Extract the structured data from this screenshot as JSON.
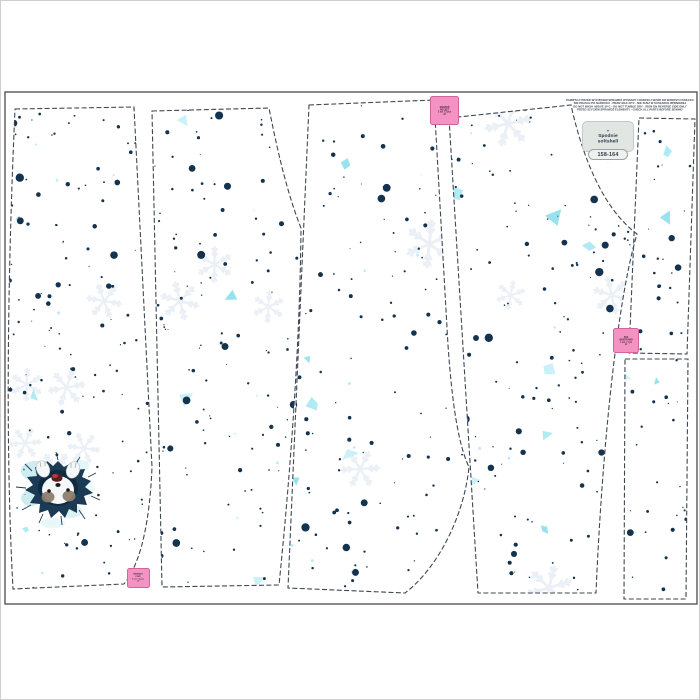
{
  "meta": {
    "title": "Fabric sewing-pattern panel preview — softshell pants, husky print"
  },
  "colors": {
    "background": "#ffffff",
    "panel_border": "#4a4a4a",
    "piece_outline": "#3f4753",
    "dot": "#14334f",
    "shards": [
      "#a9e8f1",
      "#c6f0f6",
      "#8fe0ec"
    ],
    "snowflake": "#e6edf4",
    "pink_label_bg": "#f492c2",
    "pink_label_border": "#d2639c",
    "size_tag_bg": "#e1e6e3"
  },
  "print": {
    "seed": 12,
    "dot_count": 560,
    "speck_count": 28,
    "shard_count": 24,
    "snowflake_count": 15
  },
  "disclaimer": {
    "lines": [
      "PAMIĘTAJ! PRZED WYCIĘCIEM SPRAWDŹ WYMIARY I DOPASUJ WZÓR DO WZROSTU DZIECKA",
      "NIE PRASUJ PO NADRUKU · PIERZ MAX 30°C · NIE SUSZ W SUSZARCE BĘBNOWEJ",
      "DO NOT WASH ABOVE 30°C · DO NOT TUMBLE DRY · IRON ON REVERSE SIDE ONLY",
      "PRZED SZYCIEM SPRAWDŹ ELEMENTY · CHECK ALL PARTS BEFORE SEWING"
    ]
  },
  "size_tag": {
    "brand_glyph": "✦",
    "product": "Spodnie softshell",
    "size": "158-164",
    "note": "· · ·"
  },
  "pink_labels": {
    "top": {
      "lines": [
        "KIESZEŃ",
        "POCKET",
        "2 szt. / 2 pcs",
        "x2"
      ]
    },
    "right": {
      "lines": [
        "PAS",
        "WAISTBAND",
        "1 szt. / 1 pc",
        "x1"
      ]
    },
    "bottom": {
      "lines": [
        "MANKIET",
        "CUFF",
        "2 szt. / 2 pcs",
        "x2"
      ]
    }
  },
  "artwork": {
    "motif": "Husky puppy peeking upside-down through a torn hole in the fabric"
  }
}
